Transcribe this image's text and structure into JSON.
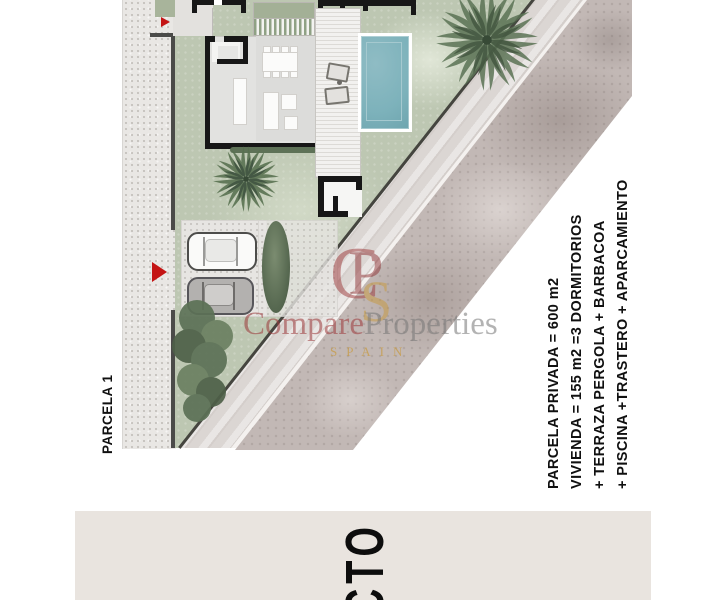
{
  "plan": {
    "parcel_label": "PARCELA 1",
    "specs": [
      "PARCELA PRIVADA = 600 m2",
      "VIVIENDA = 155 m2 =3 DORMITORIOS",
      "+ TERRAZA PERGOLA + BARBACOA",
      "+ PISCINA +TRASTERO + APARCAMIENTO"
    ]
  },
  "watermark": {
    "monogram_c": "C",
    "monogram_p": "P",
    "monogram_s": "S",
    "brand_compare": "Compare",
    "brand_properties": "Properties",
    "brand_country": "SPAIN"
  },
  "banner": {
    "title_visible": "CTO"
  },
  "colors": {
    "arrow_red": "#c41414",
    "watermark_maroon": "#9c383a",
    "watermark_gold": "#c89a3e",
    "pool_blue": "#7db2bb",
    "banner_beige": "#e9e4df",
    "lawn_green": "#bdc7b2",
    "asphalt": "#c2b8b5"
  }
}
